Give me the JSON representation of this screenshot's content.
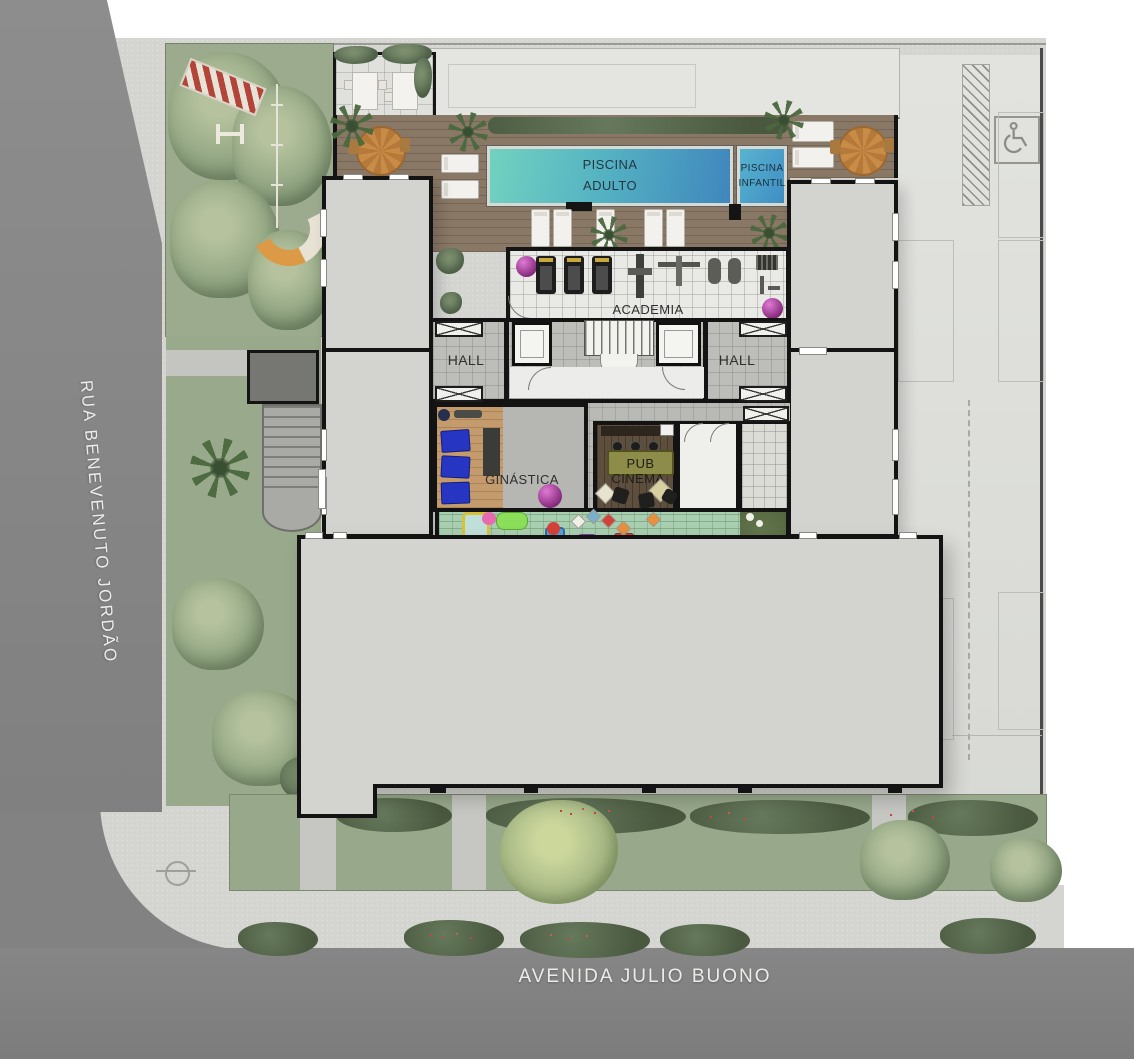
{
  "canvas": {
    "width": 1134,
    "height": 1059
  },
  "streets": {
    "left_label": "RUA BENEVENUTO JORDÃO",
    "bottom_label": "AVENIDA JULIO BUONO"
  },
  "areas": {
    "piscina_adulto": {
      "line1": "PISCINA",
      "line2": "ADULTO"
    },
    "piscina_infantil": {
      "line1": "PISCINA",
      "line2": "INFANTIL"
    },
    "academia": "ACADEMIA",
    "hall_left": "HALL",
    "hall_right": "HALL",
    "ginastica": "GINÁSTICA",
    "pub": "PUB",
    "cinema": "CINEMA",
    "playground": "PLAYGROUNDD"
  },
  "icons": {
    "accessible_parking": "wheelchair-icon"
  },
  "colors": {
    "street": "#878787",
    "sidewalk": "#d4d5d1",
    "garden": "#9cab8e",
    "building_fill": "#d3d3d0",
    "wall": "#141414",
    "deck_wood": "#8a7866",
    "pool_water_from": "#72d2c0",
    "pool_water_to": "#3f86bd",
    "kids_pool": "#4fa9cd",
    "playground_floor": "#a9cfb0",
    "pub_floor": "#5e4e3d",
    "gym_floor": "#e9e9e6",
    "label_text": "#2f2f2f",
    "street_label_text": "#ececea"
  }
}
